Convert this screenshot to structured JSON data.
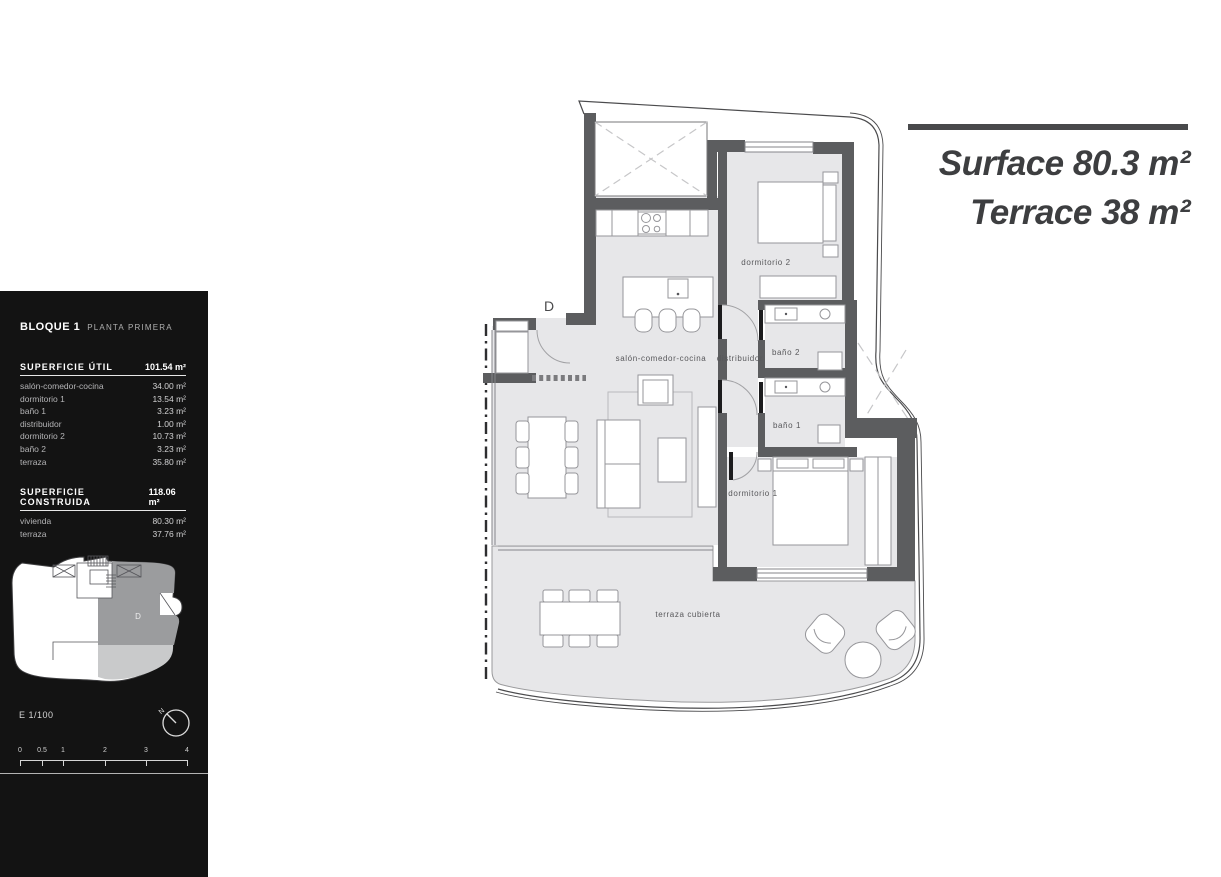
{
  "panel": {
    "title": "BLOQUE 1",
    "subtitle": "PLANTA PRIMERA",
    "useful": {
      "header": "SUPERFICIE ÚTIL",
      "total": "101.54 m²",
      "rows": [
        {
          "label": "salón-comedor-cocina",
          "value": "34.00 m²"
        },
        {
          "label": "dormitorio 1",
          "value": "13.54 m²"
        },
        {
          "label": "baño 1",
          "value": "3.23 m²"
        },
        {
          "label": "distribuidor",
          "value": "1.00 m²"
        },
        {
          "label": "dormitorio 2",
          "value": "10.73 m²"
        },
        {
          "label": "baño 2",
          "value": "3.23 m²"
        },
        {
          "label": "terraza",
          "value": "35.80 m²"
        }
      ]
    },
    "built": {
      "header": "SUPERFICIE CONSTRUIDA",
      "total": "118.06 m²",
      "rows": [
        {
          "label": "vivienda",
          "value": "80.30 m²"
        },
        {
          "label": "terraza",
          "value": "37.76 m²"
        }
      ]
    },
    "keyplan_unit_label": "D",
    "scale_text": "E 1/100",
    "compass_label": "N",
    "scalebar_ticks": [
      "0",
      "0.5",
      "1",
      "2",
      "3",
      "4"
    ]
  },
  "titles": {
    "surface": "Surface 80.3 m²",
    "terrace": "Terrace 38 m²"
  },
  "plan": {
    "entrance_label": "D",
    "rooms": {
      "salon": "salón-comedor-cocina",
      "distribuidor": "distribuidor",
      "dormitorio2": "dormitorio 2",
      "bano2": "baño 2",
      "bano1": "baño 1",
      "dormitorio1": "dormitorio 1",
      "terraza": "terraza cubierta"
    }
  },
  "colors": {
    "wall": "#5c5d5f",
    "floor": "#e7e7e9",
    "line": "#4b4b4d",
    "panel_bg": "#131313",
    "title_text": "#3d3e40",
    "keyplan_unit": "#9b9c9e",
    "keyplan_terrace": "#c9cacb"
  }
}
